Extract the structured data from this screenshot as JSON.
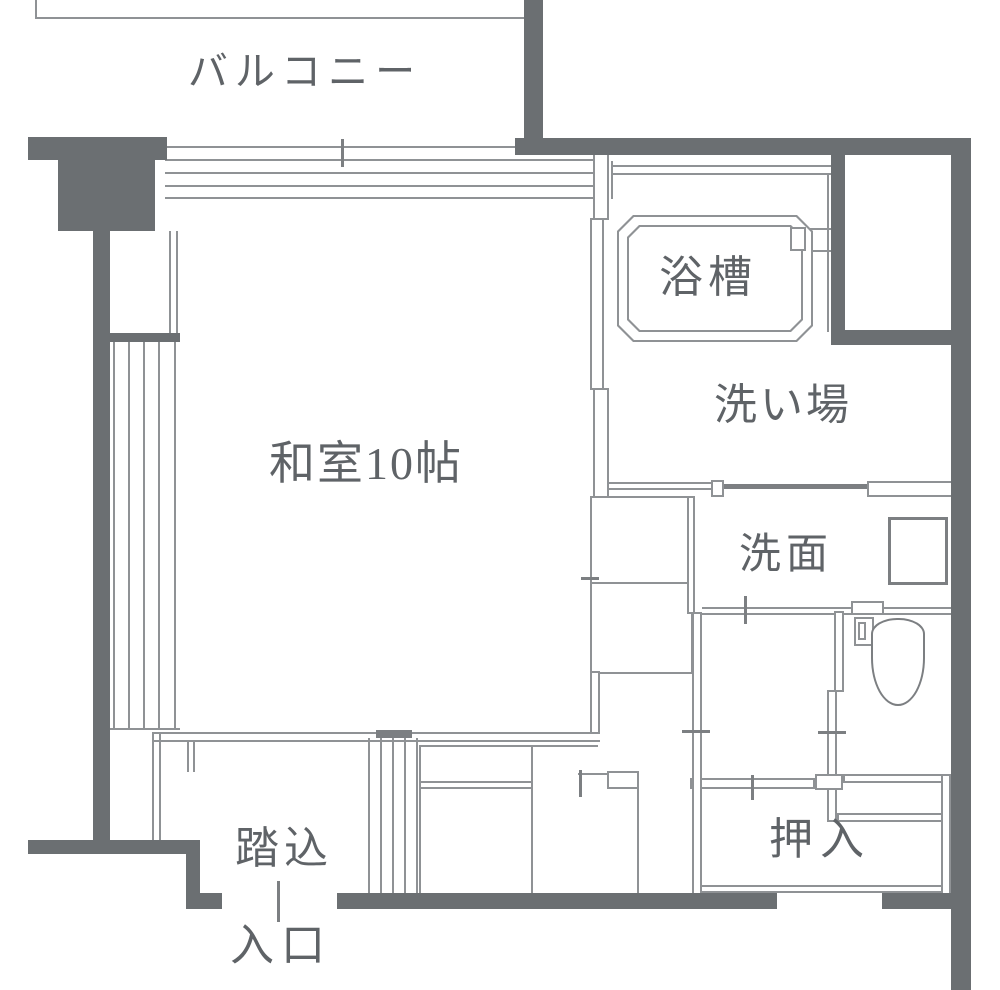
{
  "colors": {
    "wall": "#6b6f72",
    "line": "#8f9295",
    "mline": "#7c7f82",
    "text": "#5f6367",
    "white": "#ffffff"
  },
  "labels": [
    {
      "n": "balcony-label",
      "text": "バルコニー",
      "x": 305,
      "y": 72,
      "fs": 40,
      "ls": 7
    },
    {
      "n": "room-label",
      "text": "和室10帖",
      "x": 366,
      "y": 464,
      "fs": 46,
      "ls": 2
    },
    {
      "n": "bathtub-label",
      "text": "浴槽",
      "x": 708,
      "y": 278,
      "fs": 44,
      "ls": 5
    },
    {
      "n": "washplace-label",
      "text": "洗い場",
      "x": 783,
      "y": 406,
      "fs": 43,
      "ls": 3
    },
    {
      "n": "washstand-label",
      "text": "洗面",
      "x": 786,
      "y": 555,
      "fs": 42,
      "ls": 5
    },
    {
      "n": "closet-label",
      "text": "押入",
      "x": 820,
      "y": 840,
      "fs": 44,
      "ls": 7
    },
    {
      "n": "entry-step-label",
      "text": "踏込",
      "x": 284,
      "y": 849,
      "fs": 44,
      "ls": 5
    },
    {
      "n": "entrance-label",
      "text": "入口",
      "x": 281,
      "y": 946,
      "fs": 44,
      "ls": 7
    }
  ],
  "elements": [
    {
      "t": "l",
      "n": "top-boundary-line",
      "b": [
        35,
        17,
        490,
        2
      ]
    },
    {
      "t": "l",
      "n": "top-boundary-stub",
      "b": [
        35,
        0,
        2,
        17
      ]
    },
    {
      "t": "l",
      "n": "balcony-door-track-1",
      "b": [
        165,
        146,
        350,
        2
      ]
    },
    {
      "t": "l",
      "n": "balcony-door-track-2",
      "b": [
        165,
        159,
        428,
        2
      ]
    },
    {
      "t": "l",
      "n": "balcony-door-track-3",
      "b": [
        165,
        172,
        428,
        2
      ]
    },
    {
      "t": "l",
      "n": "balcony-door-track-4",
      "b": [
        165,
        185,
        428,
        2
      ]
    },
    {
      "t": "l",
      "n": "balcony-door-track-5",
      "b": [
        165,
        197,
        428,
        2
      ]
    },
    {
      "t": "l",
      "n": "balcony-door-end-a",
      "b": [
        593,
        159,
        2,
        40
      ]
    },
    {
      "t": "l",
      "n": "balcony-door-end-b",
      "b": [
        611,
        161,
        2,
        38
      ]
    },
    {
      "t": "l",
      "n": "upper-window-line-a",
      "b": [
        169,
        231,
        2,
        104
      ]
    },
    {
      "t": "l",
      "n": "upper-window-line-b",
      "b": [
        176,
        231,
        2,
        104
      ]
    },
    {
      "t": "l",
      "n": "left-window-line-1",
      "b": [
        113,
        342,
        2,
        386
      ]
    },
    {
      "t": "l",
      "n": "left-window-line-2",
      "b": [
        128,
        342,
        2,
        386
      ]
    },
    {
      "t": "l",
      "n": "left-window-line-3",
      "b": [
        143,
        342,
        2,
        386
      ]
    },
    {
      "t": "l",
      "n": "left-window-line-4",
      "b": [
        158,
        342,
        2,
        386
      ]
    },
    {
      "t": "l",
      "n": "left-window-line-5",
      "b": [
        174,
        342,
        2,
        386
      ]
    },
    {
      "t": "l",
      "n": "left-window-sill",
      "b": [
        110,
        728,
        70,
        2
      ]
    },
    {
      "t": "l",
      "n": "entry-west-line-a",
      "b": [
        152,
        734,
        2,
        108
      ]
    },
    {
      "t": "l",
      "n": "entry-west-line-b",
      "b": [
        159,
        734,
        2,
        108
      ]
    },
    {
      "t": "l",
      "n": "bath-top-finish-a",
      "b": [
        613,
        165,
        220,
        2
      ]
    },
    {
      "t": "l",
      "n": "bath-top-finish-b",
      "b": [
        613,
        173,
        220,
        2
      ]
    },
    {
      "t": "l",
      "n": "bath-east-finish",
      "b": [
        827,
        175,
        2,
        157
      ]
    },
    {
      "t": "l",
      "n": "faucet-pipe-1",
      "b": [
        806,
        228,
        27,
        2
      ]
    },
    {
      "t": "l",
      "n": "faucet-pipe-2",
      "b": [
        806,
        250,
        27,
        2
      ]
    },
    {
      "t": "l",
      "n": "washplace-south-wall-a",
      "b": [
        608,
        482,
        106,
        2
      ]
    },
    {
      "t": "l",
      "n": "washplace-south-wall-b",
      "b": [
        608,
        488,
        106,
        2
      ]
    },
    {
      "t": "m",
      "n": "washroom-sliding-door",
      "b": [
        723,
        484,
        144,
        5
      ]
    },
    {
      "t": "l",
      "n": "washstand-south-wall-a",
      "b": [
        702,
        607,
        150,
        2
      ]
    },
    {
      "t": "l",
      "n": "washstand-south-wall-b",
      "b": [
        702,
        613,
        150,
        2
      ]
    },
    {
      "t": "l",
      "n": "washstand-south-wall-c",
      "b": [
        884,
        607,
        67,
        2
      ]
    },
    {
      "t": "l",
      "n": "washstand-south-wall-d",
      "b": [
        884,
        613,
        67,
        2
      ]
    },
    {
      "t": "l",
      "n": "closet-bottom-line-a",
      "b": [
        698,
        885,
        248,
        2
      ]
    },
    {
      "t": "l",
      "n": "closet-bottom-line-b",
      "b": [
        698,
        891,
        248,
        2
      ]
    },
    {
      "t": "l",
      "n": "storage-a-top-line",
      "b": [
        420,
        745,
        178,
        2
      ]
    },
    {
      "t": "l",
      "n": "storage-b-top-line",
      "b": [
        578,
        773,
        30,
        2
      ]
    },
    {
      "t": "l",
      "n": "room-south-wall-a",
      "b": [
        152,
        732,
        448,
        2
      ]
    },
    {
      "t": "l",
      "n": "room-south-wall-b",
      "b": [
        152,
        740,
        448,
        2
      ]
    },
    {
      "t": "l",
      "n": "door-notch-a",
      "b": [
        187,
        742,
        2,
        30
      ]
    },
    {
      "t": "l",
      "n": "door-notch-b",
      "b": [
        193,
        742,
        2,
        30
      ]
    },
    {
      "t": "l",
      "n": "entry-door-line-1",
      "b": [
        368,
        738,
        2,
        156
      ]
    },
    {
      "t": "l",
      "n": "entry-door-line-2",
      "b": [
        380,
        738,
        2,
        156
      ]
    },
    {
      "t": "l",
      "n": "entry-door-line-3",
      "b": [
        392,
        738,
        2,
        156
      ]
    },
    {
      "t": "l",
      "n": "entry-door-line-4",
      "b": [
        404,
        738,
        2,
        156
      ]
    },
    {
      "t": "l",
      "n": "entry-door-line-5",
      "b": [
        416,
        738,
        2,
        156
      ]
    },
    {
      "t": "l",
      "n": "strip-divider-line",
      "b": [
        637,
        789,
        2,
        104
      ]
    },
    {
      "t": "o",
      "n": "room-east-wall-upper",
      "b": [
        593,
        150,
        16,
        70
      ]
    },
    {
      "t": "o",
      "n": "bath-sliding-door-leaf",
      "b": [
        590,
        218,
        14,
        172
      ]
    },
    {
      "t": "o",
      "n": "room-east-wall-lower",
      "b": [
        593,
        388,
        16,
        110
      ]
    },
    {
      "t": "o",
      "n": "storage-box-1",
      "b": [
        590,
        496,
        103,
        88
      ]
    },
    {
      "t": "o",
      "n": "storage-box-2",
      "b": [
        590,
        582,
        103,
        92
      ]
    },
    {
      "t": "o",
      "n": "room-se-wall",
      "b": [
        590,
        671,
        10,
        63
      ]
    },
    {
      "t": "o",
      "n": "washstand-west-wall",
      "b": [
        687,
        496,
        8,
        118
      ]
    },
    {
      "t": "o",
      "n": "bath-door-jamb",
      "b": [
        711,
        480,
        13,
        17
      ]
    },
    {
      "t": "o",
      "n": "washroom-door-leaf",
      "b": [
        867,
        481,
        86,
        16
      ]
    },
    {
      "t": "o",
      "n": "toilet-door-leaf",
      "b": [
        851,
        601,
        33,
        14
      ]
    },
    {
      "t": "o",
      "n": "toilet-west-wall-upper",
      "b": [
        834,
        611,
        10,
        81
      ]
    },
    {
      "t": "o",
      "n": "toilet-west-wall-lower",
      "b": [
        827,
        690,
        10,
        132
      ]
    },
    {
      "t": "o",
      "n": "toilet-south-wall",
      "b": [
        843,
        774,
        108,
        9
      ]
    },
    {
      "t": "o",
      "n": "toilet-nook-south-wall",
      "b": [
        837,
        813,
        114,
        9
      ]
    },
    {
      "t": "o",
      "n": "closet-north-wall",
      "b": [
        690,
        778,
        125,
        11
      ]
    },
    {
      "t": "o",
      "n": "closet-door-jamb",
      "b": [
        815,
        774,
        28,
        16
      ]
    },
    {
      "t": "o",
      "n": "storage-b-jamb",
      "b": [
        607,
        771,
        32,
        18
      ]
    },
    {
      "t": "o",
      "n": "closet-east-wall",
      "b": [
        941,
        774,
        10,
        121
      ]
    },
    {
      "t": "o",
      "n": "corridor-west-wall",
      "b": [
        692,
        612,
        10,
        283
      ]
    },
    {
      "t": "o",
      "n": "storage-a-box",
      "b": [
        419,
        745,
        114,
        150
      ]
    },
    {
      "t": "l",
      "n": "storage-a-divider-a",
      "b": [
        419,
        781,
        114,
        2
      ]
    },
    {
      "t": "l",
      "n": "storage-a-divider-b",
      "b": [
        419,
        787,
        114,
        2
      ]
    },
    {
      "t": "w",
      "n": "bath-north-wall",
      "b": [
        515,
        138,
        456,
        17
      ]
    },
    {
      "t": "w",
      "n": "balcony-divider-wall",
      "b": [
        524,
        0,
        19,
        141
      ]
    },
    {
      "t": "w",
      "n": "east-outer-wall",
      "b": [
        951,
        138,
        20,
        852
      ]
    },
    {
      "t": "w",
      "n": "northwest-corner-bar",
      "b": [
        28,
        137,
        139,
        23
      ]
    },
    {
      "t": "w",
      "n": "northwest-corner-block",
      "b": [
        58,
        160,
        97,
        71
      ]
    },
    {
      "t": "w",
      "n": "west-outer-wall",
      "b": [
        93,
        228,
        17,
        624
      ]
    },
    {
      "t": "w",
      "n": "southwest-corner-bar",
      "b": [
        28,
        840,
        172,
        14
      ]
    },
    {
      "t": "w",
      "n": "southwest-corner-step",
      "b": [
        186,
        850,
        14,
        58
      ]
    },
    {
      "t": "w",
      "n": "entrance-side-wall",
      "b": [
        186,
        893,
        36,
        16
      ]
    },
    {
      "t": "w",
      "n": "south-outer-wall",
      "b": [
        337,
        893,
        440,
        16
      ]
    },
    {
      "t": "w",
      "n": "south-outer-wall-east",
      "b": [
        882,
        893,
        89,
        16
      ]
    },
    {
      "t": "w",
      "n": "service-box-west-wall",
      "b": [
        831,
        152,
        14,
        193
      ]
    },
    {
      "t": "w",
      "n": "service-box-south-wall",
      "b": [
        831,
        330,
        140,
        15
      ]
    },
    {
      "t": "w",
      "n": "window-junction-cap",
      "b": [
        110,
        333,
        70,
        9
      ]
    },
    {
      "t": "oct",
      "n": "bathtub-outer-edge",
      "b": [
        617,
        215,
        196,
        127
      ],
      "cut": 16,
      "c": "line"
    },
    {
      "t": "oct",
      "n": "bathtub-outer-fill",
      "b": [
        619,
        217,
        192,
        123
      ],
      "cut": 15,
      "c": "white"
    },
    {
      "t": "oct",
      "n": "bathtub-inner-edge",
      "b": [
        627,
        225,
        176,
        107
      ],
      "cut": 12,
      "c": "line"
    },
    {
      "t": "oct",
      "n": "bathtub-inner-fill",
      "b": [
        629,
        227,
        172,
        103
      ],
      "cut": 11,
      "c": "white"
    },
    {
      "t": "o",
      "n": "bath-faucet",
      "b": [
        790,
        227,
        16,
        24
      ]
    },
    {
      "t": "o",
      "n": "toilet-tank",
      "b": [
        854,
        617,
        20,
        29
      ]
    },
    {
      "t": "o",
      "n": "toilet-flush-button",
      "b": [
        858,
        622,
        8,
        18
      ]
    },
    {
      "t": "bowl",
      "n": "toilet-bowl",
      "b": [
        871,
        618,
        54,
        88
      ],
      "r": "26px 26px 27px 27px / 16px 16px 48px 48px"
    },
    {
      "t": "o3",
      "n": "washstand-sink",
      "b": [
        888,
        517,
        60,
        68
      ]
    },
    {
      "t": "m",
      "n": "entry-door-cap",
      "b": [
        376,
        730,
        36,
        8
      ]
    },
    {
      "t": "m",
      "n": "balcony-grid-tick",
      "b": [
        341,
        139,
        3,
        28
      ]
    },
    {
      "t": "m",
      "n": "storage-grid-tick",
      "b": [
        581,
        577,
        18,
        3
      ]
    },
    {
      "t": "m",
      "n": "corridor-grid-tick",
      "b": [
        682,
        730,
        28,
        3
      ]
    },
    {
      "t": "m",
      "n": "toilet-grid-tick",
      "b": [
        818,
        731,
        28,
        3
      ]
    },
    {
      "t": "m",
      "n": "washstand-grid-tick",
      "b": [
        744,
        596,
        3,
        28
      ]
    },
    {
      "t": "m",
      "n": "closet-grid-tick",
      "b": [
        751,
        775,
        3,
        25
      ]
    },
    {
      "t": "m",
      "n": "storage-b-grid-tick",
      "b": [
        579,
        770,
        3,
        27
      ]
    },
    {
      "t": "m",
      "n": "entrance-grid-tick",
      "b": [
        277,
        881,
        3,
        41
      ]
    }
  ]
}
